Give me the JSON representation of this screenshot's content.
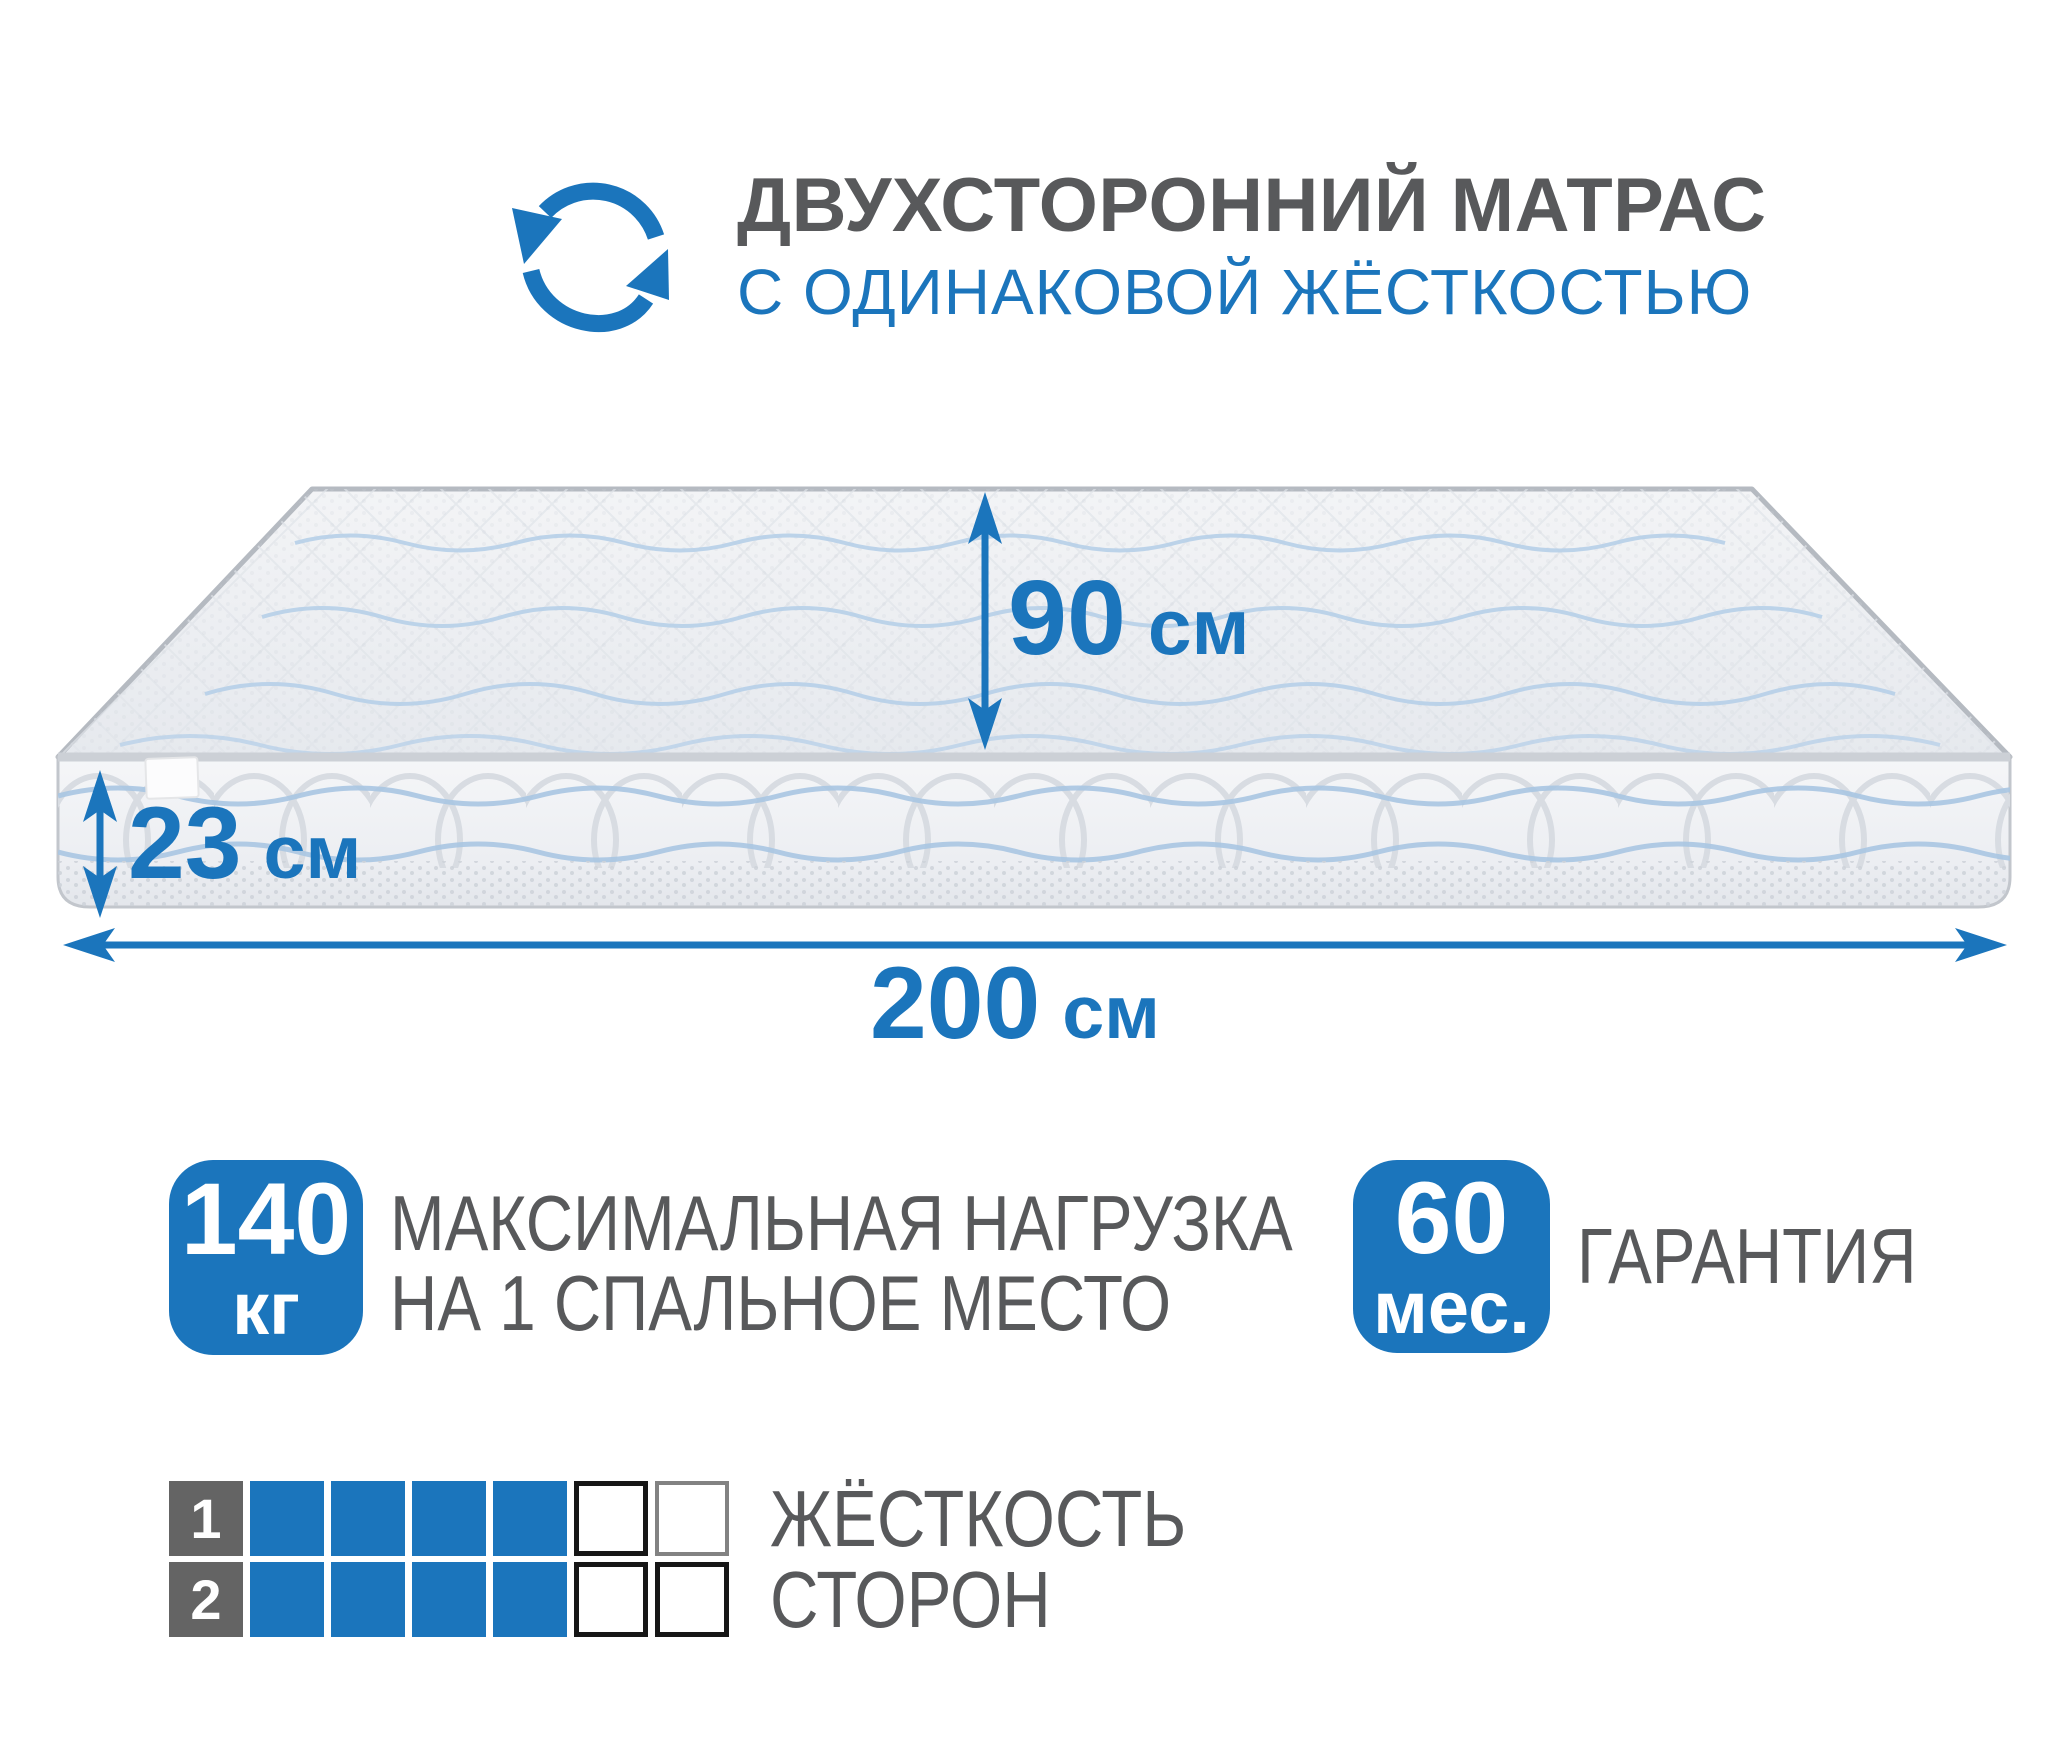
{
  "header": {
    "title": "ДВУХСТОРОННИЙ МАТРАС",
    "subtitle": "С ОДИНАКОВОЙ ЖЁСТКОСТЬЮ",
    "icon": "rotate-arrows-icon"
  },
  "dimensions": {
    "height": {
      "value": "90",
      "unit": "см"
    },
    "thickness": {
      "value": "23",
      "unit": "см"
    },
    "length": {
      "value": "200",
      "unit": "см"
    }
  },
  "load_badge": {
    "value": "140",
    "unit": "кг",
    "line1": "МАКСИМАЛЬНАЯ НАГРУЗКА",
    "line2": "НА 1 СПАЛЬНОЕ МЕСТО"
  },
  "warranty_badge": {
    "value": "60",
    "unit": "мес.",
    "label": "ГАРАНТИЯ"
  },
  "firmness_scale": {
    "line1": "ЖЁСТКОСТЬ",
    "line2": "СТОРОН",
    "max": 6,
    "rows": [
      {
        "side": "1",
        "filled": 4
      },
      {
        "side": "2",
        "filled": 4
      }
    ]
  },
  "colors": {
    "accent_blue": "#1b75bc",
    "dark_gray": "#58595b",
    "row_label_gray": "#646464"
  }
}
